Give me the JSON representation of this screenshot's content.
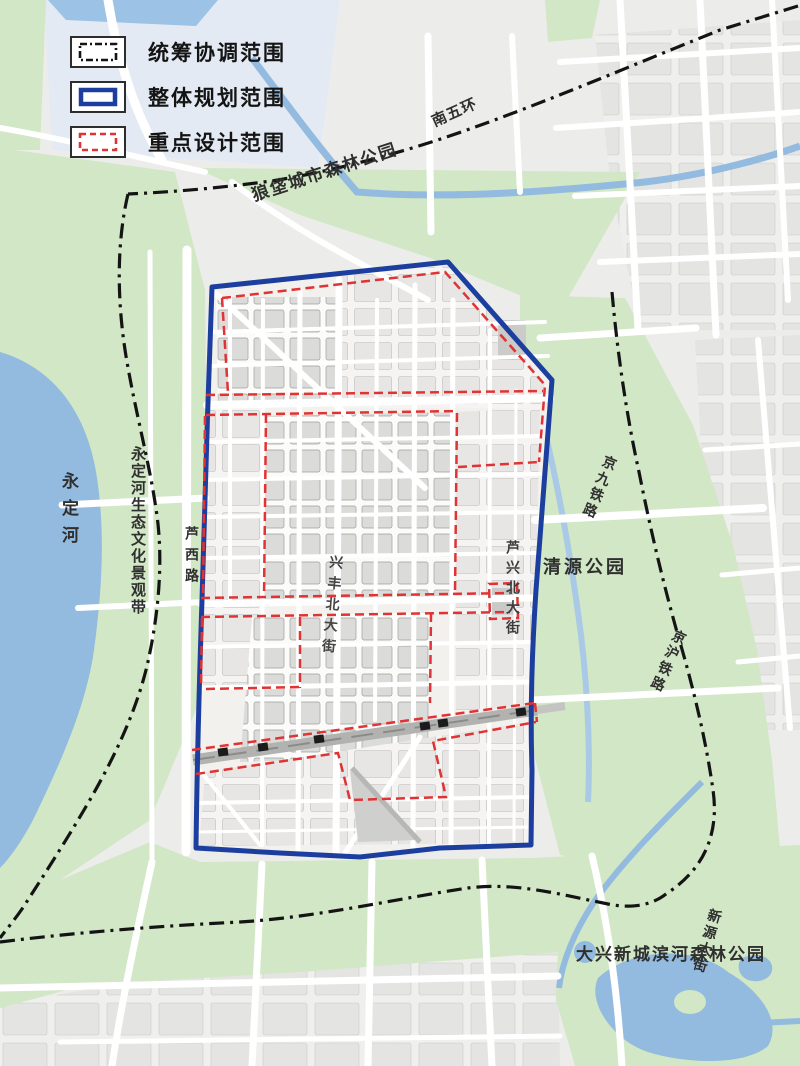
{
  "legend": {
    "items": [
      {
        "id": "coordination",
        "label": "统筹协调范围",
        "line_style": "dash-dot"
      },
      {
        "id": "overall",
        "label": "整体规划范围",
        "line_style": "solid"
      },
      {
        "id": "key-design",
        "label": "重点设计范围",
        "line_style": "dashed"
      }
    ]
  },
  "map_labels": {
    "langfa_forest_park": "狼垡城市森林公园",
    "south_fifth_ring": "南五环",
    "yongding_river": "永定河",
    "yongding_eco_belt": "永定河生态文化景观带",
    "luxi_road": "芦西路",
    "luxing_north_street": "芦兴北大街",
    "qingyuan_park": "清源公园",
    "jingjiu_railway": "京九铁路",
    "jinghu_railway": "京沪铁路",
    "xingfeng_north_street": "兴丰北大街",
    "daxing_binhe_forest_park": "大兴新城滨河森林公园",
    "xinyuan_street": "新源大街"
  },
  "colors": {
    "coordination_line": "#141414",
    "overall_line": "#1c3f9f",
    "key_design_line": "#e03333",
    "park_green": "#d2e7c5",
    "water_blue": "#93badf"
  }
}
